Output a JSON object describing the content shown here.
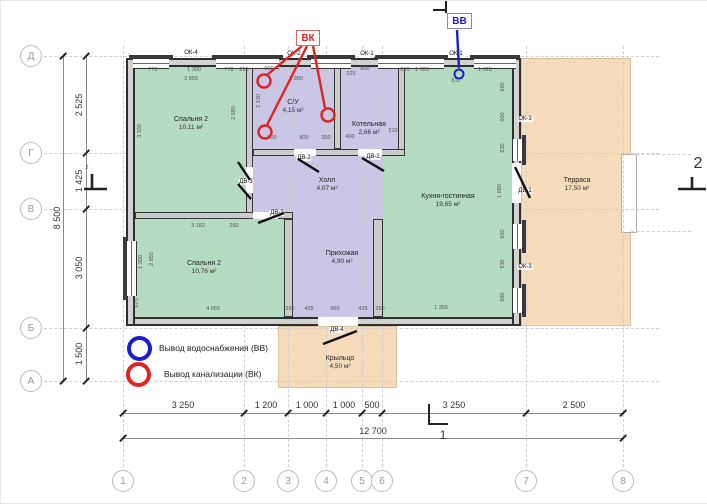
{
  "colors": {
    "room_green": "#b5dcc0",
    "room_purple": "#c9c6e6",
    "area_peach": "#f6dcba",
    "wall": "#2f2f2f",
    "annot_red": "#e02424",
    "annot_blue": "#1a1ecc"
  },
  "markers": {
    "sewer": "ВК",
    "water": "ВВ",
    "section_1": "1",
    "section_2": "2"
  },
  "legend": {
    "items": [
      {
        "icon": "circle-blue",
        "label": "Вывод водоснабжения (ВВ)"
      },
      {
        "icon": "circle-red",
        "label": "Вывод канализации (ВК)"
      }
    ]
  },
  "grid": {
    "rows": [
      {
        "label": "Д",
        "y": 55
      },
      {
        "label": "Г",
        "y": 152
      },
      {
        "label": "В",
        "y": 208
      },
      {
        "label": "Б",
        "y": 327
      },
      {
        "label": "А",
        "y": 380
      }
    ],
    "cols": [
      {
        "label": "1",
        "x": 122
      },
      {
        "label": "2",
        "x": 243
      },
      {
        "label": "3",
        "x": 287
      },
      {
        "label": "4",
        "x": 325
      },
      {
        "label": "5",
        "x": 361
      },
      {
        "label": "6",
        "x": 381
      },
      {
        "label": "7",
        "x": 525
      },
      {
        "label": "8",
        "x": 622
      }
    ]
  },
  "dims": {
    "left_total": "8 500",
    "left": [
      {
        "t": "2 525",
        "y": 104
      },
      {
        "t": "1 425",
        "y": 180
      },
      {
        "t": "3 050",
        "y": 267
      },
      {
        "t": "1 500",
        "y": 353
      }
    ],
    "bottom_total": "12 700",
    "bottom": [
      {
        "t": "3 250",
        "x": 182
      },
      {
        "t": "1 200",
        "x": 265
      },
      {
        "t": "1 000",
        "x": 306
      },
      {
        "t": "1 000",
        "x": 343
      },
      {
        "t": "500",
        "x": 371
      },
      {
        "t": "3 250",
        "x": 453
      },
      {
        "t": "2 500",
        "x": 573
      }
    ]
  },
  "rooms": [
    {
      "n": "bedroom2-top",
      "label": "Спальня 2",
      "area": "10,11 м²",
      "x": 134,
      "y": 66,
      "w": 111,
      "h": 146,
      "fill": "green",
      "lx": 190,
      "ly": 123
    },
    {
      "n": "kitchen-living",
      "label": "Кухня-гостинная",
      "area": "19,65 м²",
      "x": 382,
      "y": 66,
      "w": 129,
      "h": 250,
      "fill": "green",
      "lx": 447,
      "ly": 200
    },
    {
      "n": "bathroom",
      "label": "С/У",
      "area": "4,15 м²",
      "x": 252,
      "y": 66,
      "w": 81,
      "h": 82,
      "fill": "purple",
      "lx": 292,
      "ly": 106
    },
    {
      "n": "boiler",
      "label": "Котельная",
      "area": "2,66 м²",
      "x": 340,
      "y": 66,
      "w": 57,
      "h": 82,
      "fill": "purple",
      "lx": 368,
      "ly": 128
    },
    {
      "n": "hall",
      "label": "Холл",
      "area": "4,07 м²",
      "x": 245,
      "y": 148,
      "w": 137,
      "h": 70,
      "fill": "purple",
      "lx": 326,
      "ly": 184
    },
    {
      "n": "entry",
      "label": "Прихожая",
      "area": "4,90 м²",
      "x": 292,
      "y": 218,
      "w": 80,
      "h": 98,
      "fill": "purple",
      "lx": 341,
      "ly": 257
    },
    {
      "n": "bedroom2-bottom",
      "label": "Спальня 2",
      "area": "10,76 м²",
      "x": 134,
      "y": 218,
      "w": 149,
      "h": 98,
      "fill": "green",
      "lx": 203,
      "ly": 267
    },
    {
      "n": "terrace",
      "label": "Терраса",
      "area": "17,50 м²",
      "x": 520,
      "y": 57,
      "w": 110,
      "h": 268,
      "fill": "peach",
      "lx": 576,
      "ly": 184
    },
    {
      "n": "porch",
      "label": "Крыльцо",
      "area": "4,50 м²",
      "x": 277,
      "y": 325,
      "w": 119,
      "h": 62,
      "fill": "peach",
      "lx": 339,
      "ly": 362
    }
  ],
  "openings": {
    "windows": [
      {
        "t": "ОК-4",
        "x": 190,
        "y": 52
      },
      {
        "t": "ОК-2",
        "x": 293,
        "y": 53
      },
      {
        "t": "ОК-1",
        "x": 366,
        "y": 53
      },
      {
        "t": "ОК-1",
        "x": 455,
        "y": 53
      },
      {
        "t": "ОК-3",
        "x": 524,
        "y": 118
      },
      {
        "t": "ОК-3",
        "x": 524,
        "y": 266
      }
    ],
    "doors": [
      {
        "t": "ДВ-1",
        "x": 524,
        "y": 190
      },
      {
        "t": "ДВ-2",
        "x": 303,
        "y": 157
      },
      {
        "t": "ДВ-2",
        "x": 372,
        "y": 156
      },
      {
        "t": "ДВ-3",
        "x": 245,
        "y": 181
      },
      {
        "t": "ДВ-3",
        "x": 276,
        "y": 212
      },
      {
        "t": "ДВ-4",
        "x": 336,
        "y": 329
      }
    ]
  },
  "tiny_dims": [
    {
      "t": "778",
      "x": 152,
      "y": 69
    },
    {
      "t": "1 300",
      "x": 193,
      "y": 69
    },
    {
      "t": "778",
      "x": 228,
      "y": 69
    },
    {
      "t": "250",
      "x": 243,
      "y": 69
    },
    {
      "t": "2 855",
      "x": 190,
      "y": 78
    },
    {
      "t": "3 335",
      "x": 139,
      "y": 130,
      "r": 1
    },
    {
      "t": "2 580",
      "x": 233,
      "y": 112,
      "r": 1
    },
    {
      "t": "2 130",
      "x": 258,
      "y": 100,
      "r": 1
    },
    {
      "t": "900",
      "x": 268,
      "y": 68
    },
    {
      "t": "1 950",
      "x": 295,
      "y": 78
    },
    {
      "t": "800",
      "x": 271,
      "y": 137
    },
    {
      "t": "800",
      "x": 303,
      "y": 137
    },
    {
      "t": "350",
      "x": 325,
      "y": 137
    },
    {
      "t": "800",
      "x": 364,
      "y": 68
    },
    {
      "t": "225",
      "x": 350,
      "y": 73
    },
    {
      "t": "400",
      "x": 349,
      "y": 136
    },
    {
      "t": "210",
      "x": 392,
      "y": 130
    },
    {
      "t": "250",
      "x": 404,
      "y": 69
    },
    {
      "t": "1 028",
      "x": 421,
      "y": 69
    },
    {
      "t": "1 028",
      "x": 484,
      "y": 69
    },
    {
      "t": "812",
      "x": 455,
      "y": 80
    },
    {
      "t": "880",
      "x": 502,
      "y": 86,
      "r": 1
    },
    {
      "t": "500",
      "x": 502,
      "y": 116,
      "r": 1
    },
    {
      "t": "630",
      "x": 502,
      "y": 147,
      "r": 1
    },
    {
      "t": "1 680",
      "x": 499,
      "y": 190,
      "r": 1
    },
    {
      "t": "650",
      "x": 502,
      "y": 233,
      "r": 1
    },
    {
      "t": "930",
      "x": 502,
      "y": 263,
      "r": 1
    },
    {
      "t": "880",
      "x": 502,
      "y": 296,
      "r": 1
    },
    {
      "t": "3 182",
      "x": 197,
      "y": 225
    },
    {
      "t": "250",
      "x": 233,
      "y": 225
    },
    {
      "t": "1 300",
      "x": 140,
      "y": 261,
      "r": 1
    },
    {
      "t": "2 855",
      "x": 151,
      "y": 258,
      "r": 1
    },
    {
      "t": "675",
      "x": 136,
      "y": 302,
      "r": 1
    },
    {
      "t": "4 055",
      "x": 212,
      "y": 308
    },
    {
      "t": "250",
      "x": 289,
      "y": 308
    },
    {
      "t": "425",
      "x": 308,
      "y": 308
    },
    {
      "t": "960",
      "x": 334,
      "y": 308
    },
    {
      "t": "425",
      "x": 362,
      "y": 308
    },
    {
      "t": "250",
      "x": 379,
      "y": 308
    },
    {
      "t": "1 355",
      "x": 440,
      "y": 307
    },
    {
      "t": "2",
      "x": 86,
      "y": 167
    }
  ]
}
